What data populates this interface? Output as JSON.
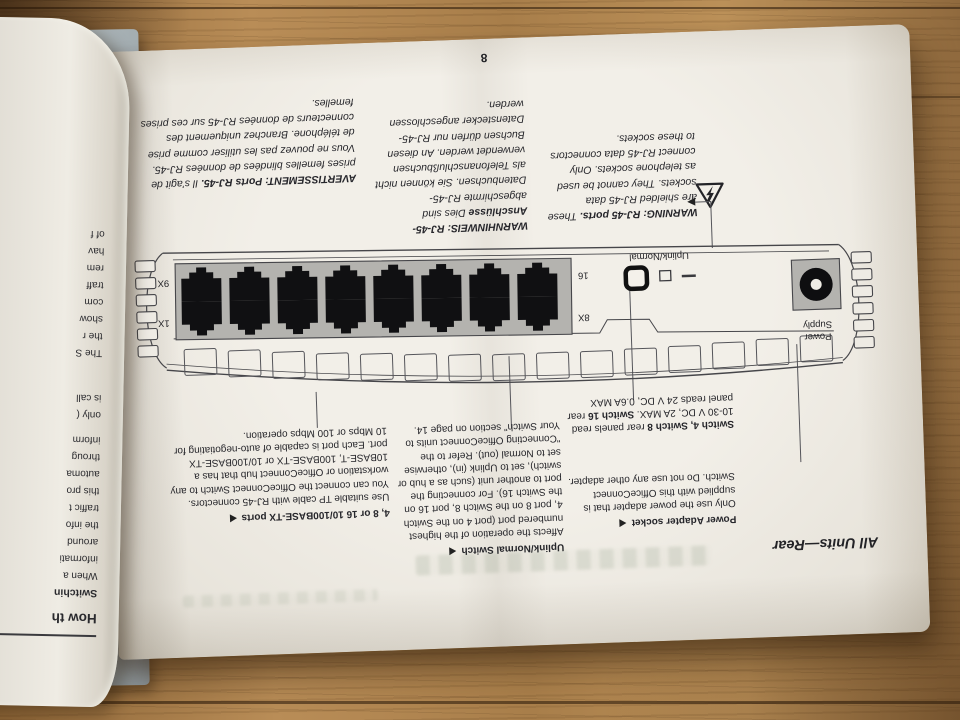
{
  "page_number": "8",
  "section_heading": "All Units—Rear",
  "warnings": {
    "french": {
      "heading": "AVERTISSEMENT: Ports RJ-45.",
      "body": "Il s'agit de prises femelles blindées de données RJ-45. Vous ne pouvez pas les utiliser comme prise de téléphone. Branchez uniquement des connecteurs de données RJ-45 sur ces prises femelles."
    },
    "german": {
      "heading": "WARNHINWEIS: RJ-45-Anschlüsse",
      "body": "Dies sind abgeschirmte RJ-45-Datenbuchsen. Sie können nicht als Telefonanschlußbuchsen verwendet werden. An diesen Buchsen dürfen nur RJ-45-Datenstecker angeschlossen werden."
    },
    "english": {
      "heading": "WARNING: RJ-45 ports.",
      "body": "These are shielded RJ-45 data sockets. They cannot be used as telephone sockets. Only connect RJ-45 data connectors to these sockets."
    }
  },
  "diagram": {
    "labels": {
      "port_9x": "9X",
      "port_1x": "1X",
      "port_16": "16",
      "port_8x": "8X",
      "uplink": "Uplink/Normal",
      "power_line1": "Power",
      "power_line2": "Supply"
    }
  },
  "callouts": {
    "ports": {
      "heading": "4, 8 or 16 10/100BASE-TX ports",
      "body": "Use suitable TP cable with RJ-45 connectors. You can connect the OfficeConnect Switch to any workstation or OfficeConnect hub that has a 10BASE-T, 100BASE-TX or 10/100BASE-TX port. Each port is capable of auto-negotiating for 10 Mbps or 100 Mbps operation."
    },
    "uplink": {
      "heading": "Uplink/Normal Switch",
      "body": "Affects the operation of the highest numbered port (port 4 on the Switch 4, port 8 on the Switch 8, port 16 on the Switch 16). For connecting the port to another unit (such as a hub or switch), set to Uplink (in), otherwise set to Normal (out). Refer to the \"Connecting OfficeConnect units to Your Switch\" section on page 14."
    },
    "power_note": {
      "bold1": "Switch 4, Switch 8",
      "rest1": " rear panels read 10-30 V DC, 2A MAX. ",
      "bold2": "Switch 16",
      "rest2": " rear panel reads 24 V DC, 0.6A MAX"
    },
    "power": {
      "heading": "Power Adapter socket",
      "body": "Only use the power adapter that is supplied with this OfficeConnect Switch. Do not use any other adapter."
    }
  },
  "left_page": {
    "fragments": [
      "How th",
      "Switchin",
      "When a",
      "informati",
      "around",
      "the info",
      "traffic t",
      "this pro",
      "automa",
      "throug",
      "inform",
      "only (",
      "is call",
      "The S",
      "the r",
      "show",
      "com",
      "traff",
      "rem",
      "hav",
      "of f"
    ]
  },
  "colors": {
    "page": "#eeebe4",
    "ink": "#232327",
    "wood": "#a87e4a",
    "cover_edge": "#a9b3b7",
    "diagram_gray": "#b4b3af"
  }
}
